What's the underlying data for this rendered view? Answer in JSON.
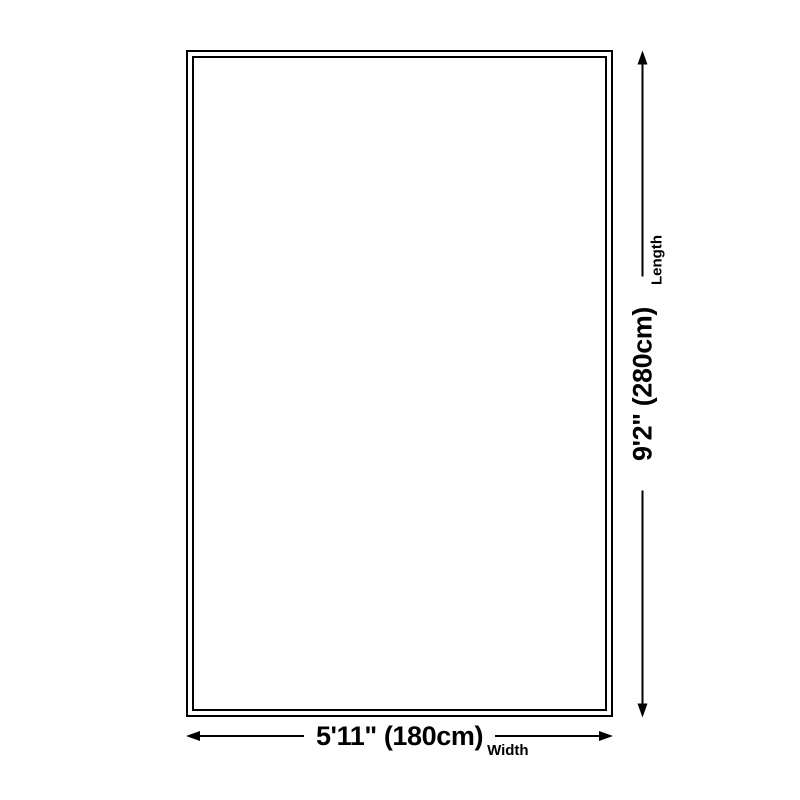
{
  "diagram": {
    "background_color": "#ffffff",
    "line_color": "#000000",
    "width_dimension": {
      "value": "5'11\" (180cm)",
      "label": "Width"
    },
    "length_dimension": {
      "value": "9'2\" (280cm)",
      "label": "Length"
    }
  }
}
